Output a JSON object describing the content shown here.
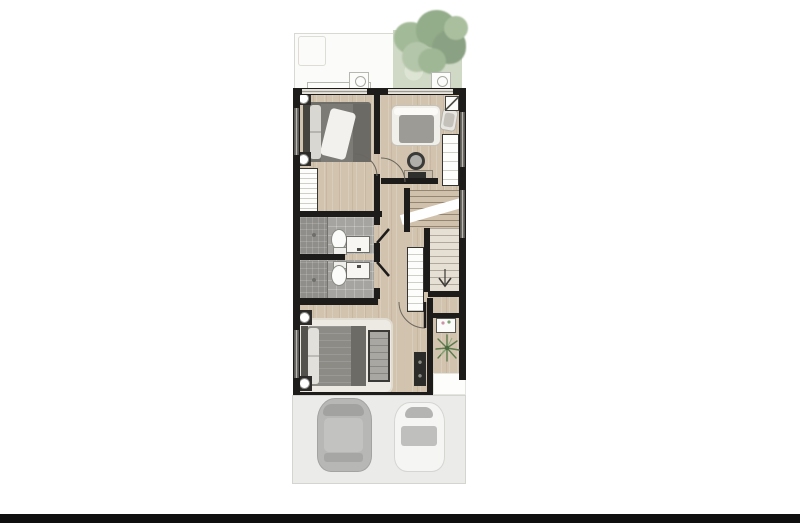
{
  "scene": {
    "description": "Top-down 3D rendered floor plan of a townhouse upper floor with terrace, garden tree and two-car carport",
    "text_labels": [],
    "areas": [
      {
        "name": "terrace"
      },
      {
        "name": "garden-with-tree"
      },
      {
        "name": "bedroom-2"
      },
      {
        "name": "bedroom-3"
      },
      {
        "name": "bathroom-1"
      },
      {
        "name": "bathroom-2"
      },
      {
        "name": "hallway"
      },
      {
        "name": "staircase"
      },
      {
        "name": "master-bedroom"
      },
      {
        "name": "entry-foyer"
      },
      {
        "name": "carport-driveway"
      }
    ],
    "objects": [
      "double-bed",
      "single-bed",
      "lounge-chair",
      "desk",
      "monitor",
      "stool",
      "wardrobe",
      "linen-cabinet",
      "toilet",
      "vanity-sink",
      "shower",
      "tv-console",
      "bedroom-bench",
      "nightstand",
      "table-lamp",
      "shag-rug",
      "console-table",
      "flower-vase",
      "potted-plant",
      "ac-condenser-units",
      "tree",
      "gray-car",
      "white-car",
      "stairs-down-arrow",
      "door-swing-arcs"
    ],
    "counts": {
      "bedrooms": 3,
      "bathrooms": 2,
      "cars": 2
    }
  },
  "palette": {
    "background": "#ffffff",
    "wall": "#1d1c1a",
    "wood_floor": "#d2c3ae",
    "bath_tile": "#a5a4a0",
    "shower_tile": "#8f8e8a",
    "rug": "#edeae3",
    "duvet_gray": "#7c7b76",
    "tree_green": "#93ac89",
    "garden_wash": "#cfd9c6",
    "driveway": "#ebebe9",
    "car_gray": "#b9b9b7",
    "car_white": "#f5f5f3",
    "cabinet_white": "#fdfdfc",
    "footer_bar": "#0f0f0f"
  }
}
